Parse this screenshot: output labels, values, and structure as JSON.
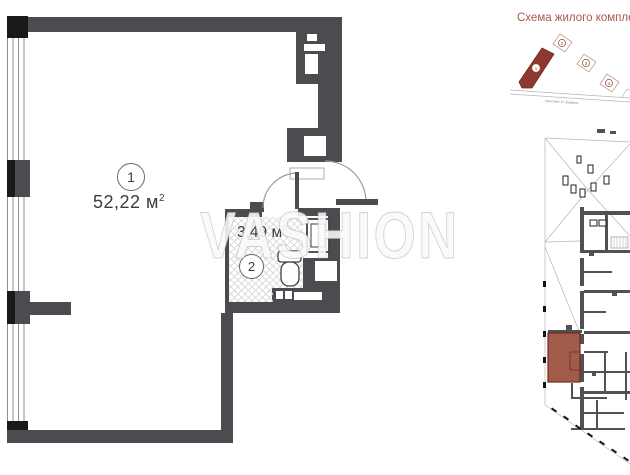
{
  "watermark": {
    "text": "VASHION"
  },
  "plan": {
    "rooms": [
      {
        "number": "1",
        "area": "52,22",
        "unit": " м",
        "sup": "2"
      },
      {
        "number": "2",
        "area": "3,49",
        "unit": " м",
        "sup": "2"
      }
    ]
  },
  "site": {
    "title": "Схема жилого комплекса",
    "street_label": "проспект Н. Бажана",
    "buildings": [
      "1",
      "2",
      "3",
      "4"
    ]
  },
  "colors": {
    "wall": "#4b4b50",
    "black": "#191919",
    "line": "#9a9a9a",
    "hatch": "#d6d6d6",
    "text": "#3c3c3c",
    "accent": "#a8584a",
    "site_fill": "#8e392d",
    "unit_fill": "#a25a49",
    "unit_stroke": "#6f2d1f"
  }
}
